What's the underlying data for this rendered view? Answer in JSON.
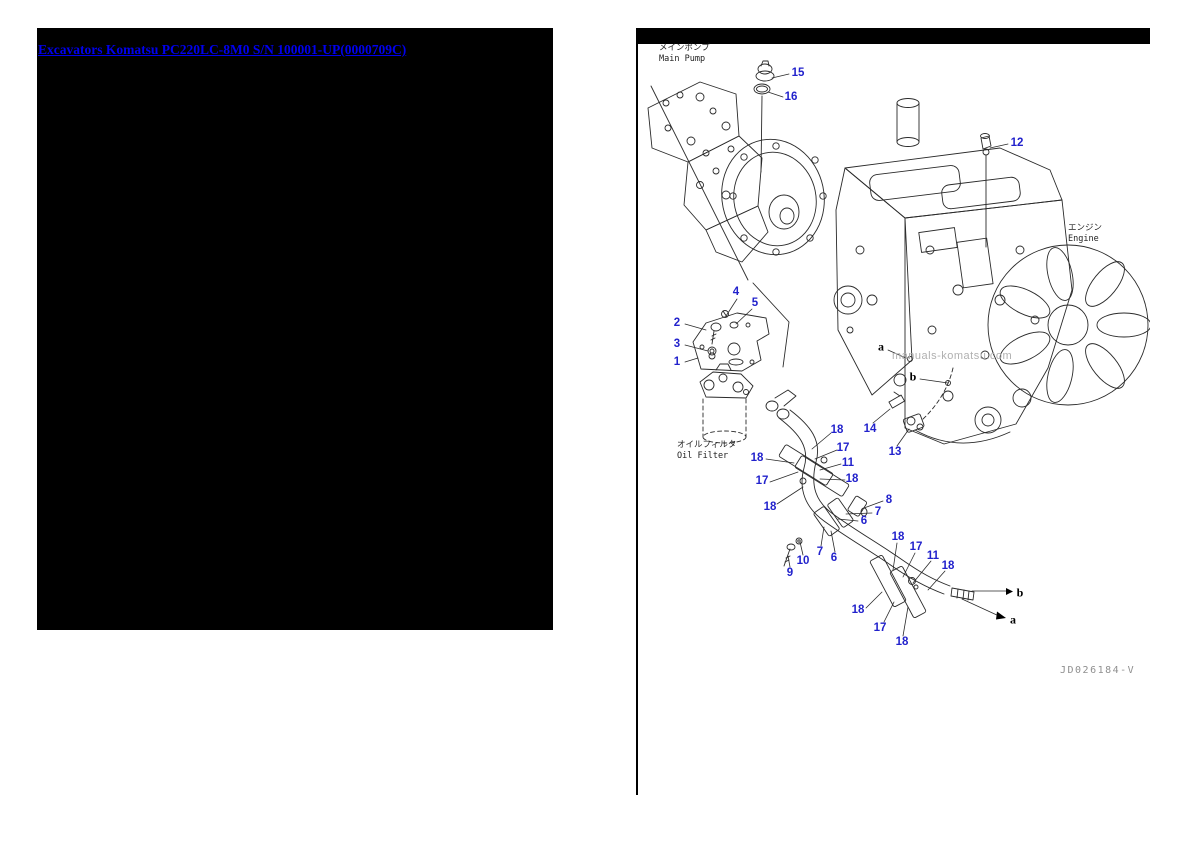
{
  "left_panel": {
    "link_text": "Excavators Komatsu PC220LC-8M0 S/N 100001-UP(0000709C)"
  },
  "diagram_page": {
    "labels": {
      "main_pump": {
        "jp": "メインポンプ",
        "en": "Main Pump"
      },
      "engine": {
        "jp": "エンジン",
        "en": "Engine"
      },
      "oil_filter": {
        "jp": "オイルフィルタ",
        "en": "Oil Filter"
      }
    },
    "watermark": "manuals-komatsu.com",
    "drawing_number": "JD026184-V",
    "callout_color": "#2222cc",
    "callouts": [
      {
        "label": "15",
        "x": 798,
        "y": 73
      },
      {
        "label": "16",
        "x": 791,
        "y": 97
      },
      {
        "label": "12",
        "x": 1017,
        "y": 143
      },
      {
        "label": "4",
        "x": 736,
        "y": 292
      },
      {
        "label": "5",
        "x": 755,
        "y": 303
      },
      {
        "label": "2",
        "x": 677,
        "y": 323
      },
      {
        "label": "3",
        "x": 677,
        "y": 344
      },
      {
        "label": "1",
        "x": 677,
        "y": 362
      },
      {
        "label": "a",
        "x": 881,
        "y": 347,
        "type": "letter"
      },
      {
        "label": "b",
        "x": 913,
        "y": 377,
        "type": "letter"
      },
      {
        "label": "14",
        "x": 870,
        "y": 429
      },
      {
        "label": "13",
        "x": 895,
        "y": 452
      },
      {
        "label": "18",
        "x": 837,
        "y": 430
      },
      {
        "label": "17",
        "x": 843,
        "y": 448
      },
      {
        "label": "11",
        "x": 848,
        "y": 463
      },
      {
        "label": "18",
        "x": 757,
        "y": 458
      },
      {
        "label": "17",
        "x": 762,
        "y": 481
      },
      {
        "label": "18",
        "x": 852,
        "y": 479
      },
      {
        "label": "18",
        "x": 770,
        "y": 507
      },
      {
        "label": "8",
        "x": 889,
        "y": 500
      },
      {
        "label": "7",
        "x": 878,
        "y": 512
      },
      {
        "label": "6",
        "x": 864,
        "y": 521
      },
      {
        "label": "7",
        "x": 820,
        "y": 552
      },
      {
        "label": "6",
        "x": 834,
        "y": 558
      },
      {
        "label": "10",
        "x": 803,
        "y": 561
      },
      {
        "label": "9",
        "x": 790,
        "y": 573
      },
      {
        "label": "18",
        "x": 898,
        "y": 537
      },
      {
        "label": "17",
        "x": 916,
        "y": 547
      },
      {
        "label": "11",
        "x": 933,
        "y": 556
      },
      {
        "label": "18",
        "x": 948,
        "y": 566
      },
      {
        "label": "18",
        "x": 858,
        "y": 610
      },
      {
        "label": "17",
        "x": 880,
        "y": 628
      },
      {
        "label": "18",
        "x": 902,
        "y": 642
      },
      {
        "label": "b",
        "x": 1020,
        "y": 593,
        "type": "letter"
      },
      {
        "label": "a",
        "x": 1013,
        "y": 620,
        "type": "letter"
      }
    ]
  }
}
